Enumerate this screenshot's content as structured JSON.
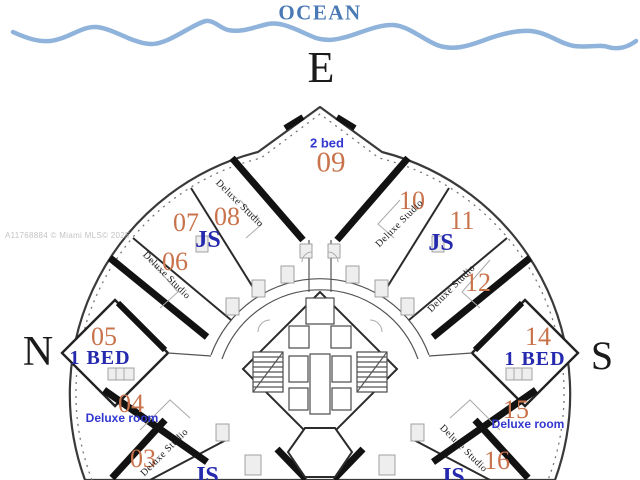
{
  "colors": {
    "ocean-text": "#4a7ab5",
    "wave": "#8fb3da",
    "unit-number": "#c9734d",
    "suite-blue": "#2429ad",
    "sans-blue": "#3137cf",
    "wall": "#121212",
    "watermark": "#c3c3c3",
    "compass": "#1b1b1b"
  },
  "ocean": {
    "label": "OCEAN"
  },
  "compass": {
    "east": "E",
    "north": "N",
    "south": "S"
  },
  "watermark": {
    "text": "A11768884 © Miami MLS© 2025"
  },
  "units": [
    {
      "number": "03",
      "type": "Deluxe Studio"
    },
    {
      "number": "04",
      "type": "Deluxe room"
    },
    {
      "number": "05",
      "type": "1 BED"
    },
    {
      "number": "06",
      "type": "Deluxe Studio"
    },
    {
      "number": "07",
      "type": "JS"
    },
    {
      "number": "08",
      "type": "Deluxe Studio"
    },
    {
      "number": "09",
      "type": "2 bed"
    },
    {
      "number": "10",
      "type": "Deluxe Studio"
    },
    {
      "number": "11",
      "type": "JS"
    },
    {
      "number": "12",
      "type": "Deluxe Studio"
    },
    {
      "number": "14",
      "type": "1 BED"
    },
    {
      "number": "15",
      "type": "Deluxe room"
    },
    {
      "number": "16",
      "type": "Deluxe Studio"
    }
  ],
  "partial_labels": {
    "bottom_left_suite": "JS",
    "bottom_right_suite": "JS"
  }
}
